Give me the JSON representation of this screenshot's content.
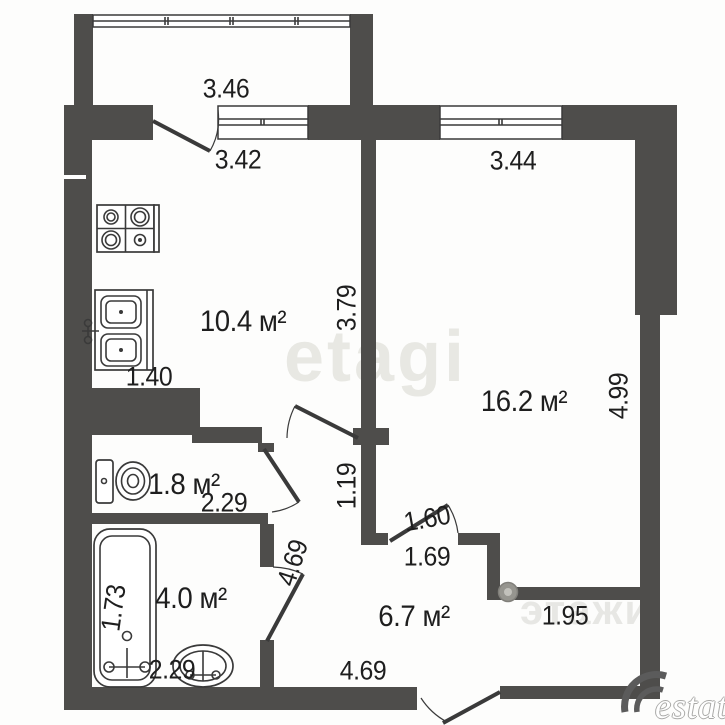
{
  "plan": {
    "title": "apartment floor plan",
    "rooms": {
      "kitchen": {
        "area": "10.4 м²"
      },
      "living": {
        "area": "16.2 м²"
      },
      "wc": {
        "area": "1.8 м²"
      },
      "bathroom": {
        "area": "4.0 м²"
      },
      "hallway": {
        "area": "6.7 м²"
      }
    },
    "labels": {
      "balcony_width": "3.46",
      "balcony_door_width": "3.42",
      "living_window_width": "3.44",
      "kitchen_depth": "3.79",
      "living_depth": "4.99",
      "sink_width": "1.40",
      "wc_width": "2.29",
      "hall_passage": "1.19",
      "living_door": "1.60",
      "living_door_wall": "1.69",
      "bath_door_side": "4.69",
      "bath_depth": "1.73",
      "bath_width": "2.29",
      "hall_width": "4.69",
      "entry_niche": "1.95"
    },
    "watermarks": {
      "center": "etagi",
      "faint_bottom": "этажи",
      "corner_text": "estate"
    },
    "colors": {
      "wall": "#4e4d4b",
      "line": "#3a3a3a",
      "watermark": "#e8e8e3"
    }
  }
}
